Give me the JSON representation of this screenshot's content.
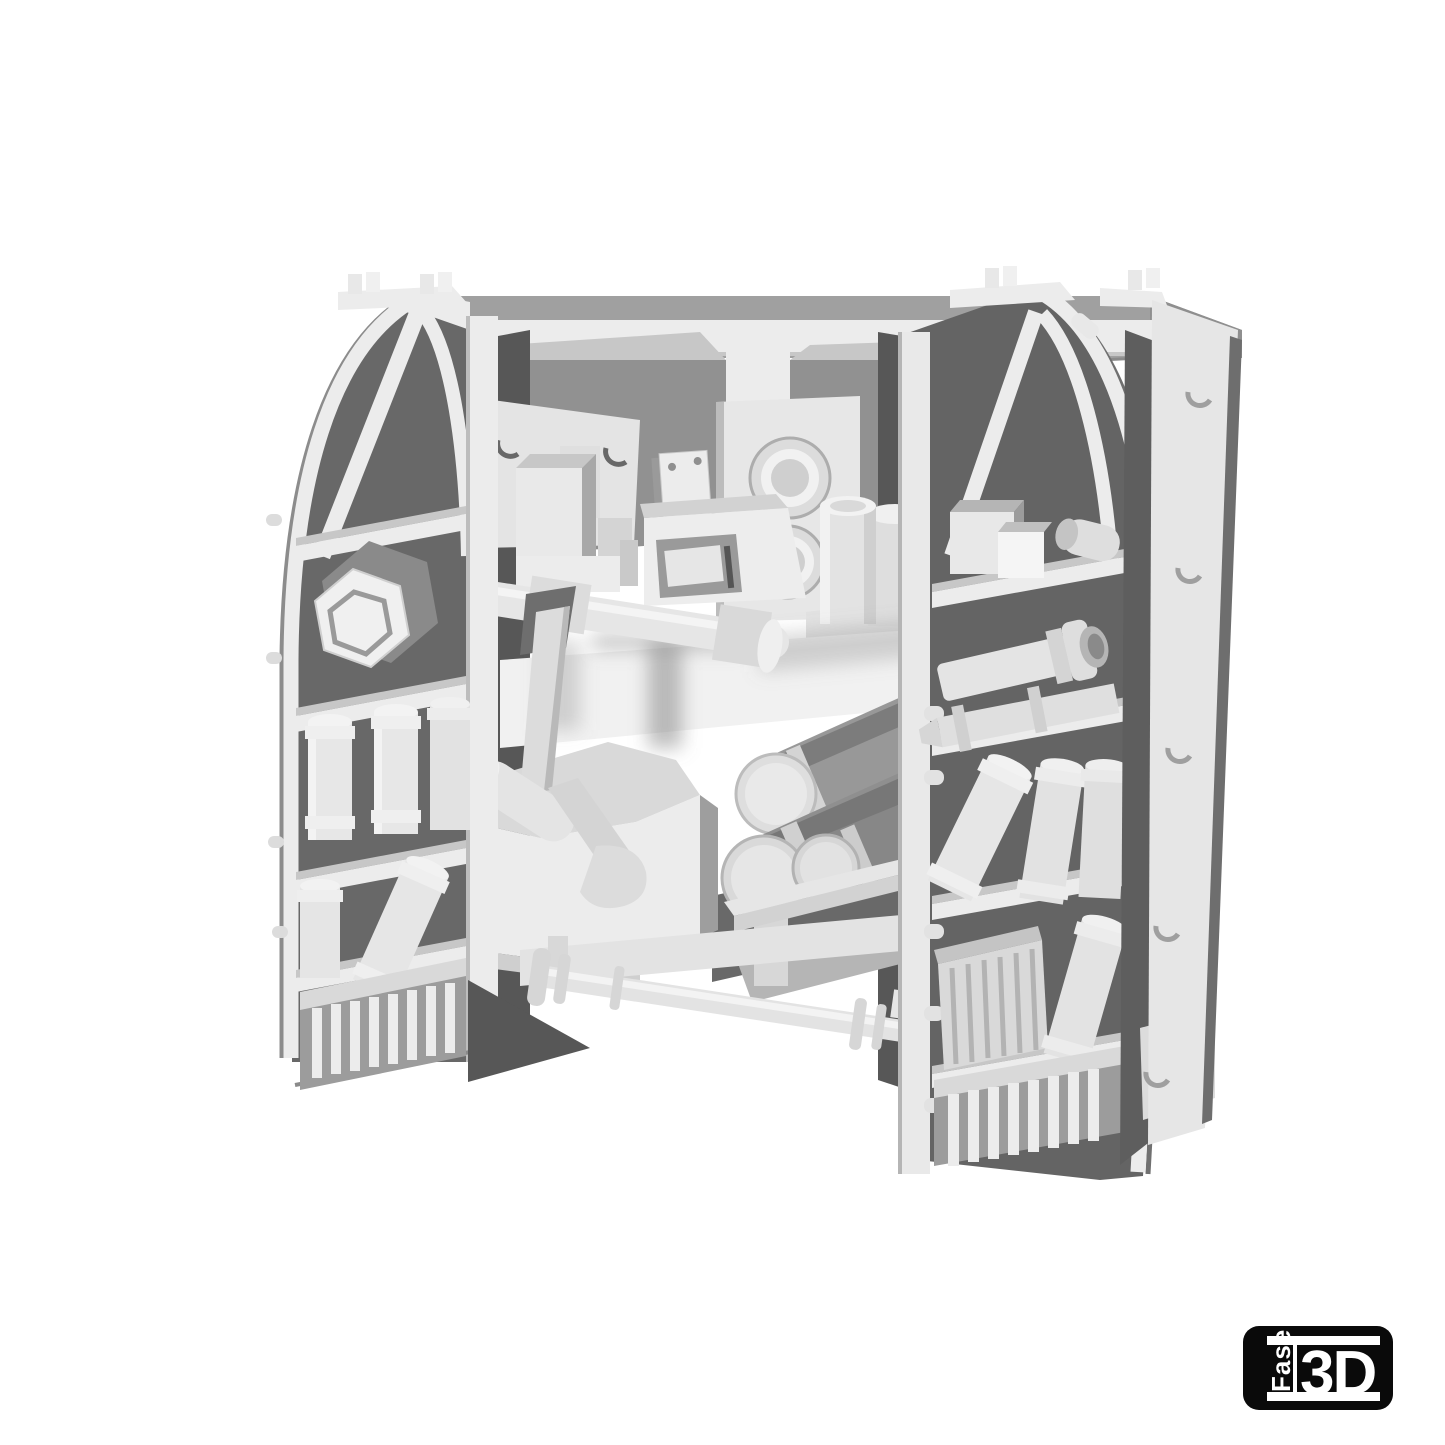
{
  "alt_text": "Monochrome 3D render of a sci-fi workshop wall: two pointed-arch shelf units packed with canisters, tubes, a hex nut, crates and vented grills, flanking central machinery with gauge plates, a robotic arm, large shell cylinders and connecting pipes, on a plain white background",
  "palette": {
    "bg": "#ffffff",
    "hi": "#f5f5f5",
    "light": "#ececec",
    "soft": "#dedede",
    "mid": "#c7c7c7",
    "gray": "#a0a0a0",
    "slate": "#8f8f8f",
    "dark": "#686868",
    "deep": "#575757",
    "ink": "#0a0a0a"
  },
  "logo": {
    "vertical_text": "Fase",
    "main_text": "3D",
    "background": "#0a0a0a",
    "text_color": "#ffffff"
  }
}
